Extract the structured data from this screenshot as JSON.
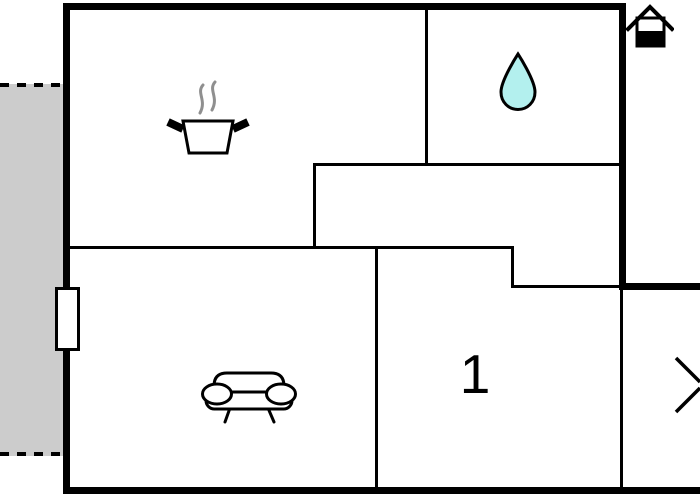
{
  "page": {
    "type": "floor-plan"
  },
  "colors": {
    "wall": "#000000",
    "terrace_fill": "#cccccc",
    "water_drop_fill": "#b3f0ee",
    "steam": "#8f8f8f",
    "background": "#ffffff"
  },
  "rooms": {
    "kitchen": {
      "icon": "cooking-pot-icon"
    },
    "bathroom": {
      "icon": "water-drop-icon"
    },
    "living_room": {
      "icon": "sofa-icon"
    },
    "bedroom": {
      "label": "1"
    }
  },
  "symbols": {
    "orientation": "house-icon",
    "neighbor_mark": "chevron-right-icon"
  },
  "terrace": {
    "position": "left",
    "border_style": "dashed"
  }
}
